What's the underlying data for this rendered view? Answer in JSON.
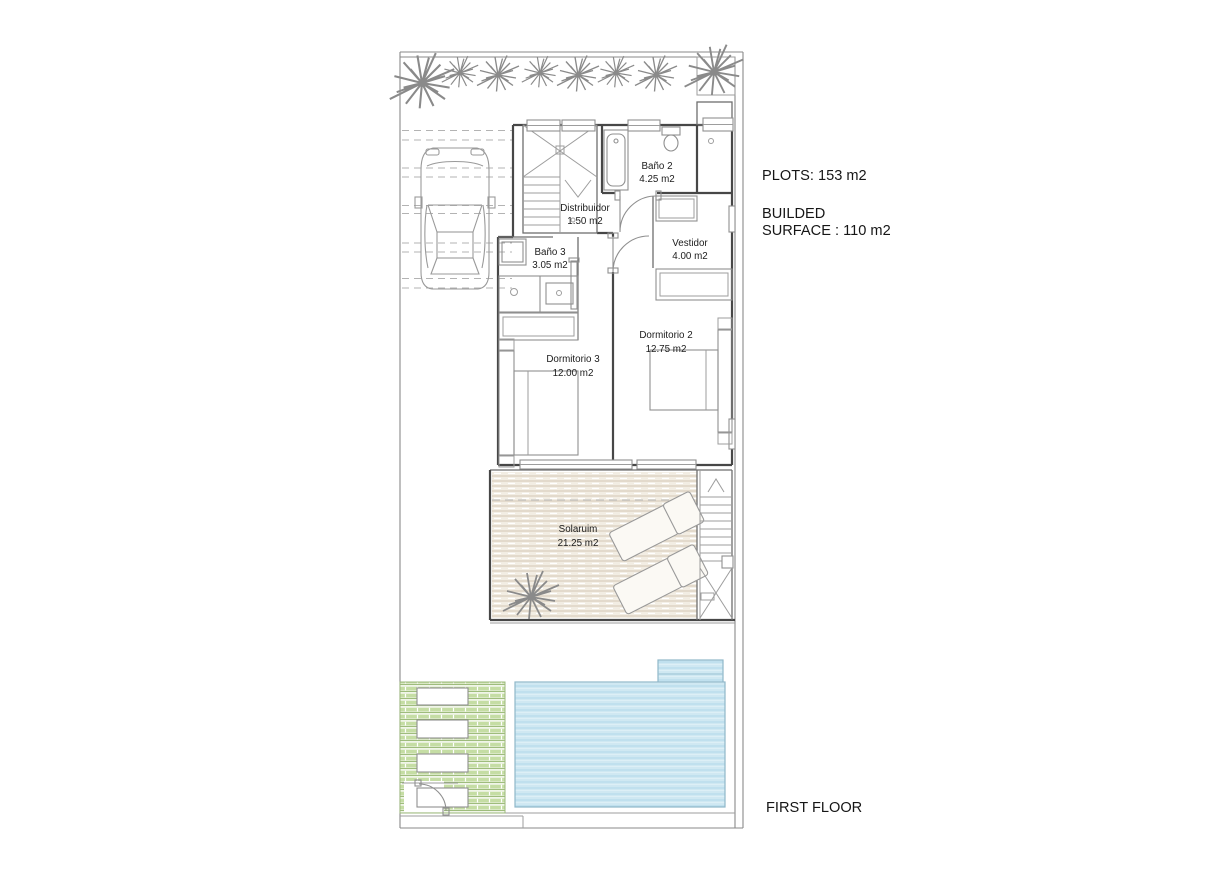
{
  "annotations": {
    "plots": "PLOTS: 153 m2",
    "builded_line1": "BUILDED",
    "builded_line2": "SURFACE : 110 m2",
    "floor": "FIRST FLOOR"
  },
  "rooms": [
    {
      "name": "Baño 2",
      "area": "4.25 m2"
    },
    {
      "name": "Distribuidor",
      "area": "1.50 m2"
    },
    {
      "name": "Baño 3",
      "area": "3.05 m2"
    },
    {
      "name": "Vestidor",
      "area": "4.00 m2"
    },
    {
      "name": "Dormitorio 2",
      "area": "12.75 m2"
    },
    {
      "name": "Dormitorio 3",
      "area": "12.00 m2"
    },
    {
      "name": "Solaruim",
      "area": "21.25 m2"
    }
  ],
  "colors": {
    "walls": "#474747",
    "thin_lines": "#9d9d9d",
    "pool_fill": "#cfe8f2",
    "pool_stripe": "#b9dded",
    "deck_fill": "#f2ede3",
    "deck_stripe": "#ddd3c3",
    "garden_fill": "#f0f5e8",
    "garden_stripe": "#c5dda4",
    "text": "#1a1a1a"
  }
}
